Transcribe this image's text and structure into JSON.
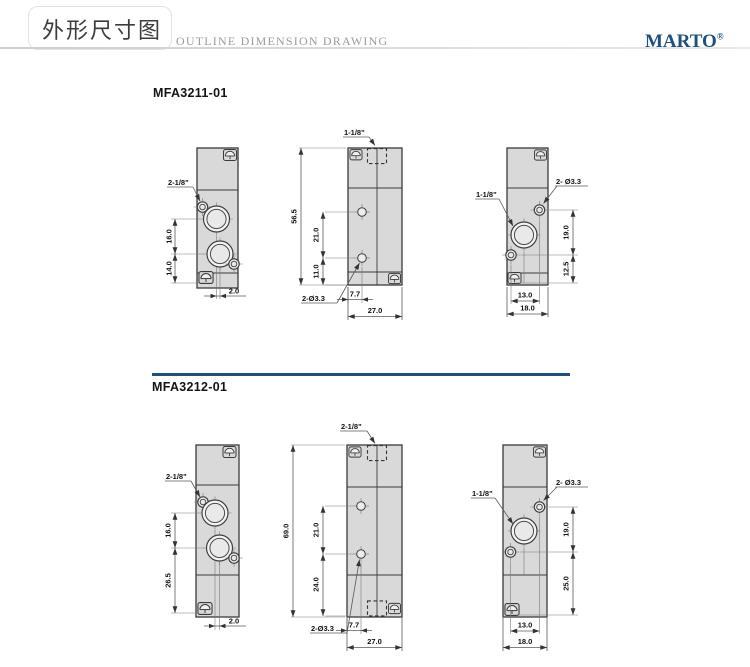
{
  "header": {
    "title_cn": "外形尺寸图",
    "subtitle": "OUTLINE DIMENSION DRAWING",
    "brand": "MARTO",
    "brand_mark": "®"
  },
  "colors": {
    "brand_blue": "#1d5080",
    "divider_blue": "#1d4f80",
    "body_gray": "#d9d9d9"
  },
  "sections": [
    {
      "model": "MFA3211-01",
      "left_view": {
        "port": "2-1/8\"",
        "dim_port_spacing": "16.0",
        "dim_port_bottom": "14.0",
        "dim_offset": "2.0"
      },
      "front_view": {
        "port": "1-1/8\"",
        "dim_height": "56.5",
        "dim_hole_spacing": "21.0",
        "dim_hole_bottom": "11.0",
        "holes": "2-Ø3.3",
        "dim_hole_x": "7.7",
        "dim_width": "27.0"
      },
      "side_view": {
        "port": "1-1/8\"",
        "holes": "2- Ø3.3",
        "dim_upper": "19.0",
        "dim_lower": "12.5",
        "dim_hole_span": "13.0",
        "dim_width": "18.0"
      }
    },
    {
      "model": "MFA3212-01",
      "left_view": {
        "port": "2-1/8\"",
        "dim_port_spacing": "16.0",
        "dim_port_bottom": "26.5",
        "dim_offset": "2.0"
      },
      "front_view": {
        "port": "2-1/8\"",
        "dim_height": "69.0",
        "dim_hole_spacing": "21.0",
        "dim_hole_bottom": "24.0",
        "holes": "2-Ø3.3",
        "dim_hole_x": "7.7",
        "dim_width": "27.0"
      },
      "side_view": {
        "port": "1-1/8\"",
        "holes": "2- Ø3.3",
        "dim_upper": "19.0",
        "dim_lower": "25.0",
        "dim_hole_span": "13.0",
        "dim_width": "18.0"
      }
    }
  ]
}
